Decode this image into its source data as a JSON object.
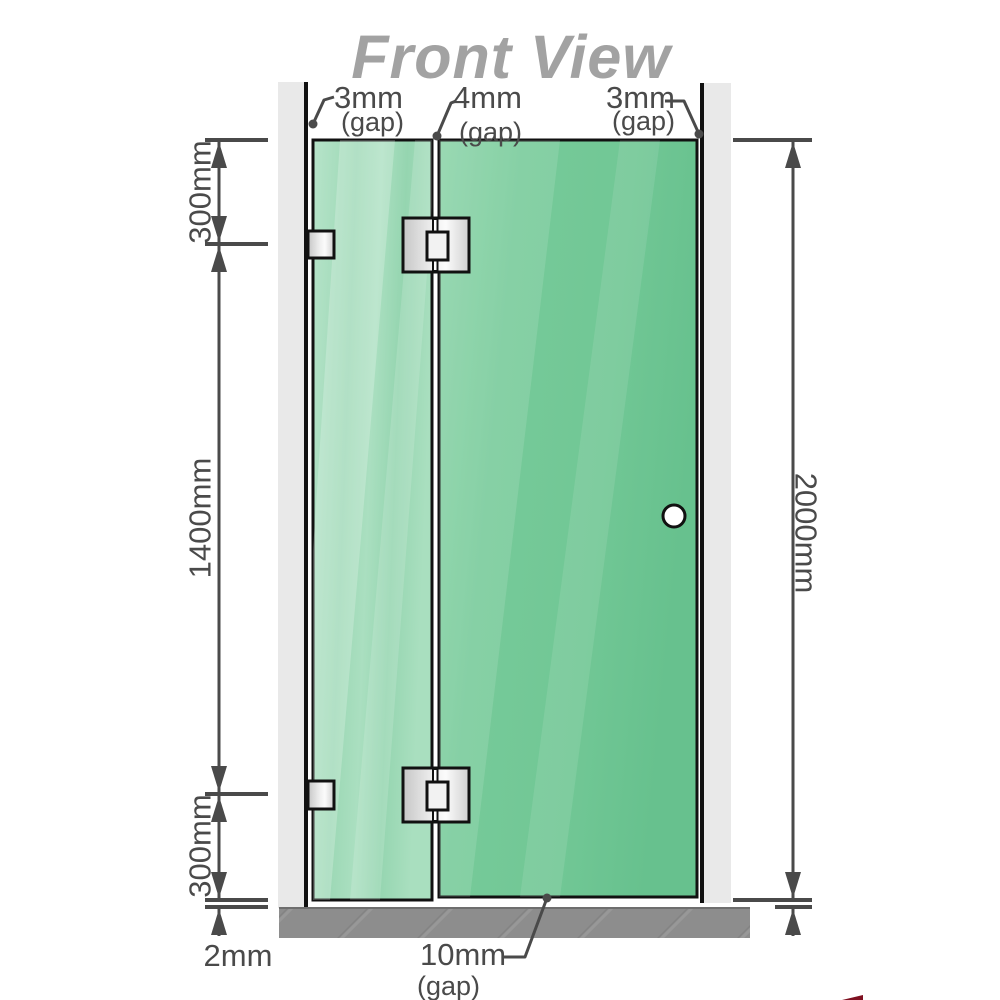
{
  "title": "Front View",
  "gaps": {
    "top_left": {
      "value": "3mm",
      "suffix": "(gap)"
    },
    "top_middle": {
      "value": "4mm",
      "suffix": "(gap)"
    },
    "top_right": {
      "value": "3mm",
      "suffix": "(gap)"
    },
    "bottom": {
      "value": "10mm",
      "suffix": "(gap)"
    }
  },
  "dimensions": {
    "left_top": "300mm",
    "left_middle": "1400mm",
    "left_bottom": "300mm",
    "left_floor_gap": "2mm",
    "right_height": "2000mm"
  },
  "colors": {
    "title": "#a2a2a2",
    "dimension": "#4a4a4a",
    "wall": "#e9e9e9",
    "floor": "#8d8d8d",
    "glass_door": "#74c897",
    "glass_panel": "#a3dcba",
    "knob_fill": "#ffffff",
    "outline": "#111111",
    "watermark_red": "#7e1020"
  },
  "shapes": {
    "left_panel": "fixed-glass-panel",
    "right_panel": "hinged-glass-door",
    "knob": "round-door-knob",
    "hinges": "glass-to-glass-hinge",
    "brackets": "wall-to-glass-bracket"
  }
}
